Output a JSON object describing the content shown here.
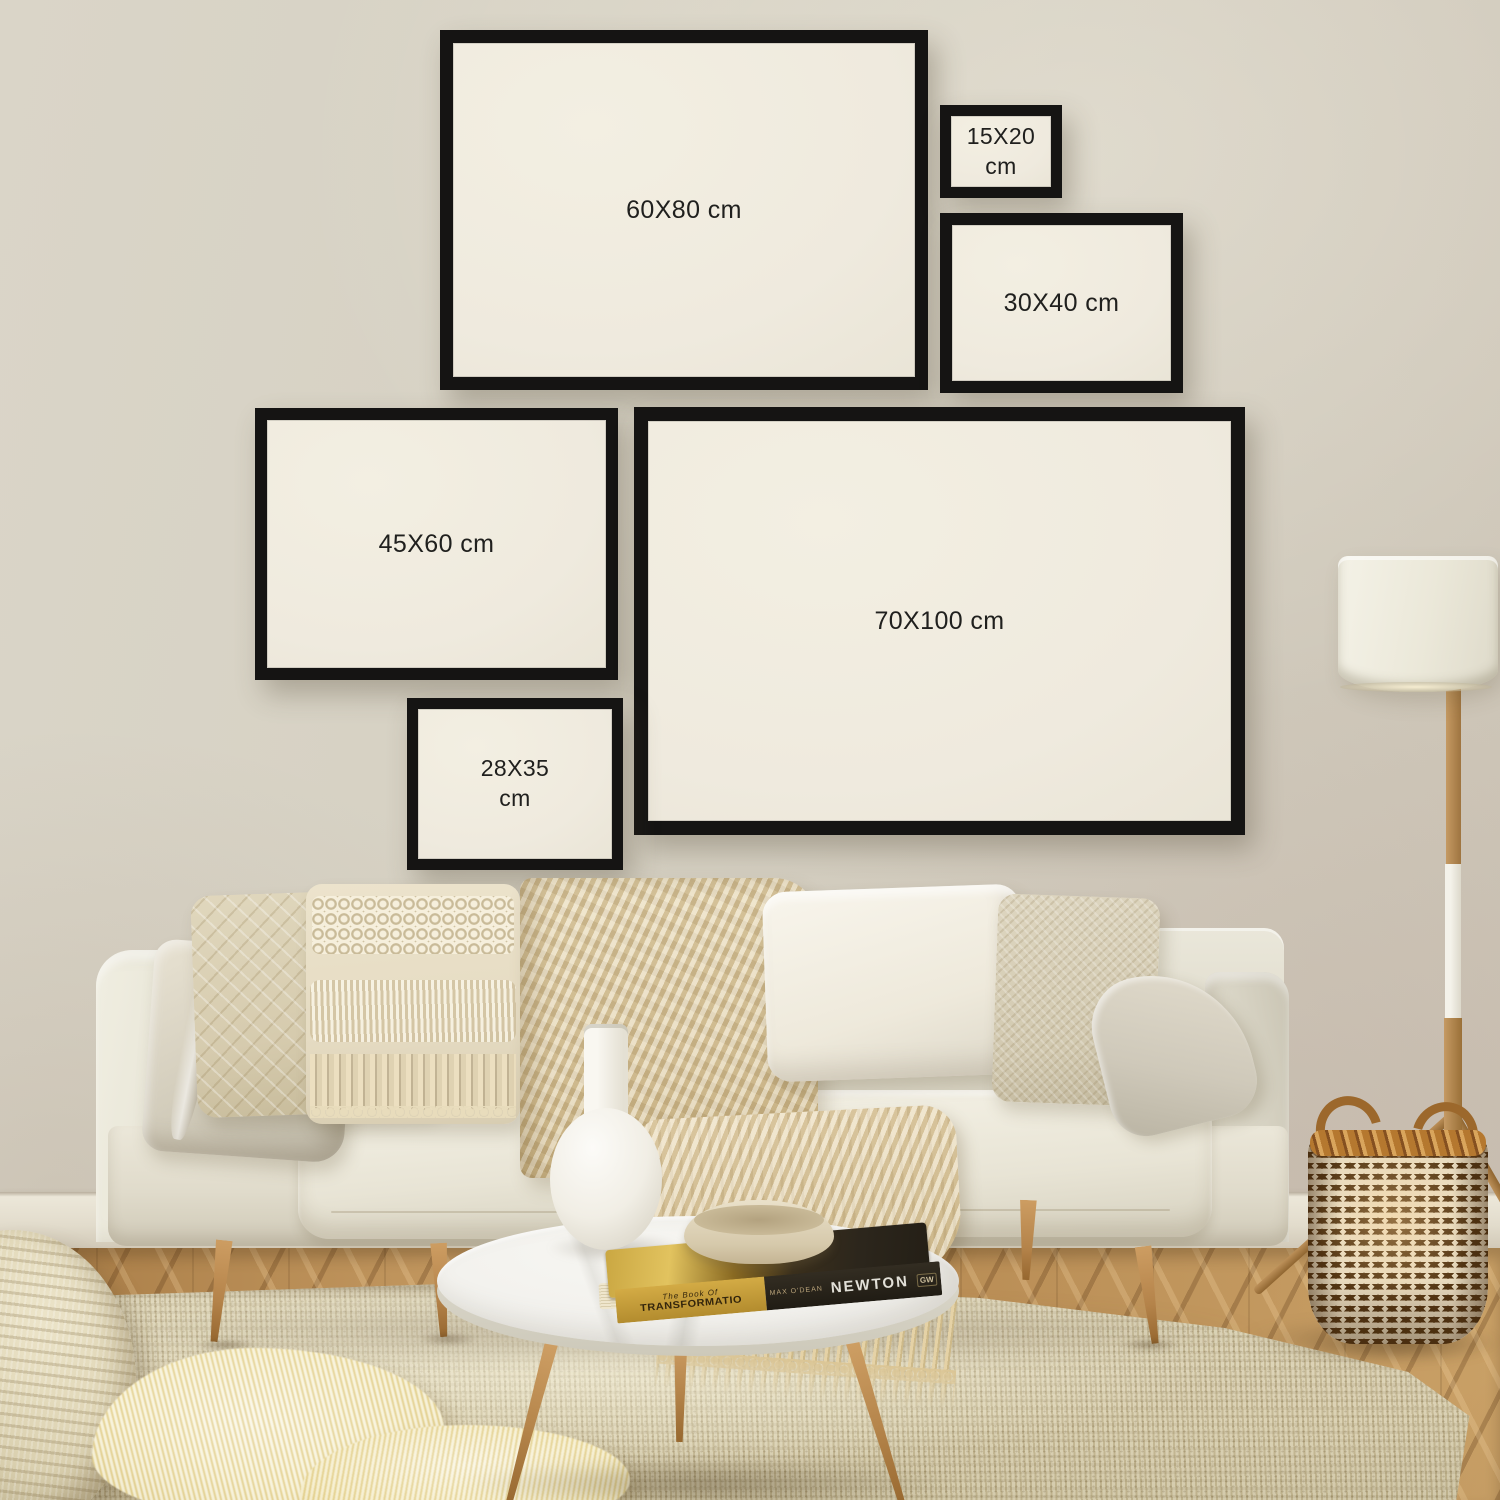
{
  "frames": [
    {
      "id": "60x80",
      "label": "60X80 cm"
    },
    {
      "id": "15x20",
      "label": "15X20 cm"
    },
    {
      "id": "30x40",
      "label": "30X40 cm"
    },
    {
      "id": "45x60",
      "label": "45X60 cm"
    },
    {
      "id": "70x100",
      "label": "70X100 cm"
    },
    {
      "id": "28x35",
      "label": "28X35 cm"
    }
  ],
  "book": {
    "series": "The Book Of",
    "title": "TRANSFORMATIO",
    "author": "MAX O'DEAN",
    "author_surname": "NEWTON",
    "publisher": "GW"
  },
  "colors": {
    "wall": "#d4cec0",
    "frame_border": "#151413",
    "frame_paper": "#efeade",
    "label_text": "#20201e",
    "sofa": "#e8e4d6",
    "rug": "#d6cba9",
    "wood_floor": "#b98d55",
    "wood_legs": "#c59a63",
    "basket_brown": "#543614",
    "basket_rim": "#b5782f",
    "lamp_shade": "#ebe8d9",
    "throw": "#e2d2ab",
    "table_marble": "#f3f2ee",
    "book_gold": "#caa742",
    "book_cover": "#241f16"
  }
}
